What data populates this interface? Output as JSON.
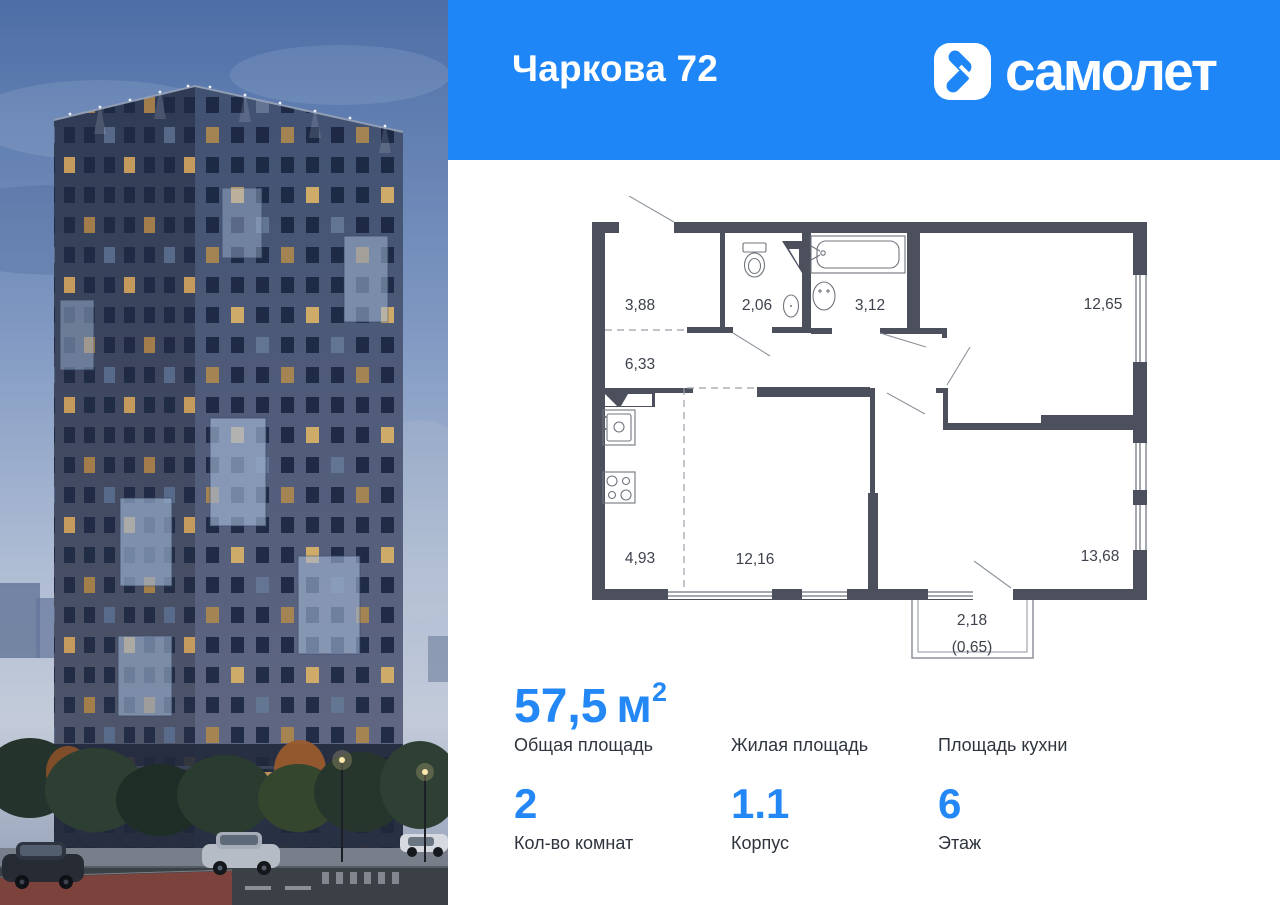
{
  "header": {
    "project_title": "Чаркова 72",
    "brand": "самолет",
    "bg_color": "#1E86F6"
  },
  "floor_plan": {
    "rooms": [
      {
        "name": "hallway",
        "area": "3,88"
      },
      {
        "name": "wc",
        "area": "2,06"
      },
      {
        "name": "bathroom",
        "area": "3,12"
      },
      {
        "name": "bedroom",
        "area": "12,65"
      },
      {
        "name": "corridor",
        "area": "6,33"
      },
      {
        "name": "kitchen",
        "area": "4,93"
      },
      {
        "name": "living-room",
        "area": "12,16"
      },
      {
        "name": "bedroom-2",
        "area": "13,68"
      },
      {
        "name": "balcony",
        "area": "2,18",
        "area_reduced": "(0,65)"
      }
    ]
  },
  "stats": {
    "total_area": {
      "value": "57,5",
      "unit": "м",
      "sup": "2",
      "label": "Общая площадь"
    },
    "living_area": {
      "value": "",
      "label": "Жилая площадь"
    },
    "kitchen_area": {
      "value": "",
      "label": "Площадь кухни"
    },
    "rooms_count": {
      "value": "2",
      "label": "Кол-во комнат"
    },
    "building": {
      "value": "1.1",
      "label": "Корпус"
    },
    "floor": {
      "value": "6",
      "label": "Этаж"
    }
  },
  "colors": {
    "accent": "#2387F6",
    "header_bg": "#1E86F6",
    "plan_wall": "#4b505c",
    "text_dark": "#2f353e"
  }
}
